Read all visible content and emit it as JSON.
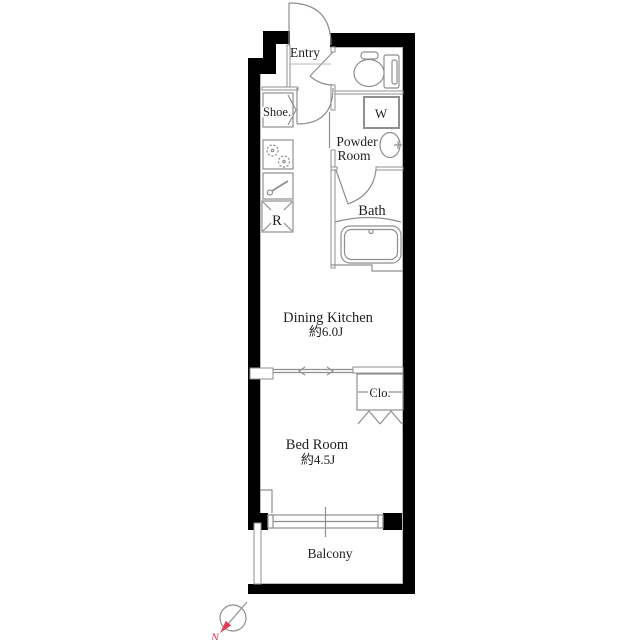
{
  "plan": {
    "type": "apartment-floor-plan",
    "labels": {
      "entry": "Entry",
      "shoe": "Shoe.",
      "powder_line1": "Powder",
      "powder_line2": "Room",
      "washer": "W",
      "bath": "Bath",
      "refrigerator": "R",
      "dining_kitchen": "Dining Kitchen",
      "dining_kitchen_size": "約6.0J",
      "closet": "Clo.",
      "bedroom": "Bed Room",
      "bedroom_size": "約4.5J",
      "balcony": "Balcony",
      "compass_north": "N"
    },
    "icons": [
      "entry-door-icon",
      "toilet-door-icon",
      "corridor-door-icon",
      "bath-door-icon",
      "toilet-icon",
      "washbasin-icon",
      "washer-box-icon",
      "bathtub-icon",
      "stove-icon",
      "kitchen-sink-icon",
      "refrigerator-box-icon",
      "shoe-cabinet-icon",
      "sliding-door-icon",
      "bifold-door-icon",
      "sliding-window-icon",
      "compass-icon"
    ]
  },
  "colors": {
    "wall": "#000000",
    "line": "#8f8f8f",
    "faint": "#b9b9b9",
    "text": "#1f1f1f",
    "accent": "#e23a5a",
    "bg": "#ffffff"
  }
}
